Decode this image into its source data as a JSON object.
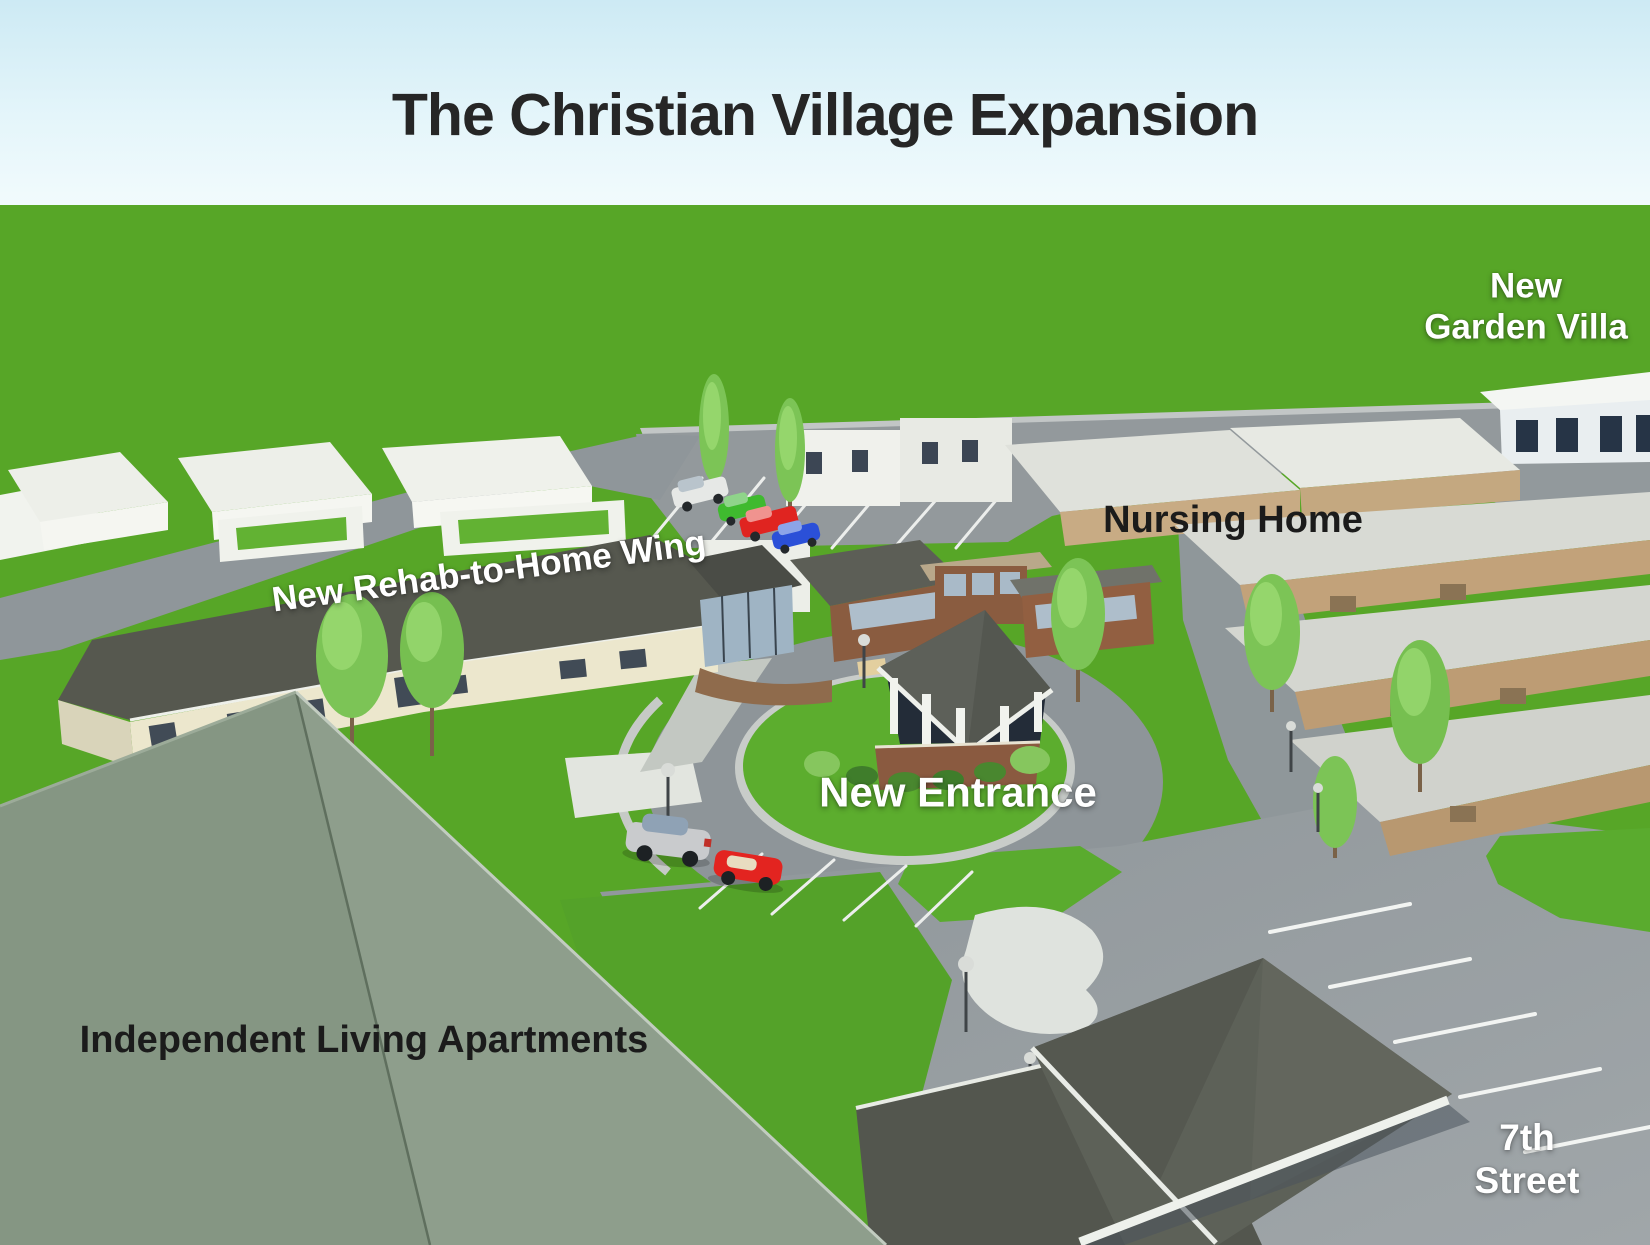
{
  "title": "The Christian Village Expansion",
  "labels": {
    "garden_villa_line1": "New",
    "garden_villa_line2": "Garden Villa",
    "nursing_home": "Nursing Home",
    "rehab_wing": "New Rehab-to-Home Wing",
    "new_entrance": "New Entrance",
    "independent_living": "Independent Living Apartments",
    "street_line1": "7th",
    "street_line2": "Street"
  },
  "colors": {
    "sky_top": "#cdeaf4",
    "sky_horizon": "#f2fbfd",
    "grass": "#57a627",
    "road": "#92989b",
    "dark_roof": "#56584f",
    "sage_roof": "#8a9a88",
    "tan_wall": "#c2a27c",
    "brick": "#8a5a40",
    "white_trim": "#eef0ea",
    "label_white": "#ffffff",
    "label_black": "#1b1b1b"
  }
}
